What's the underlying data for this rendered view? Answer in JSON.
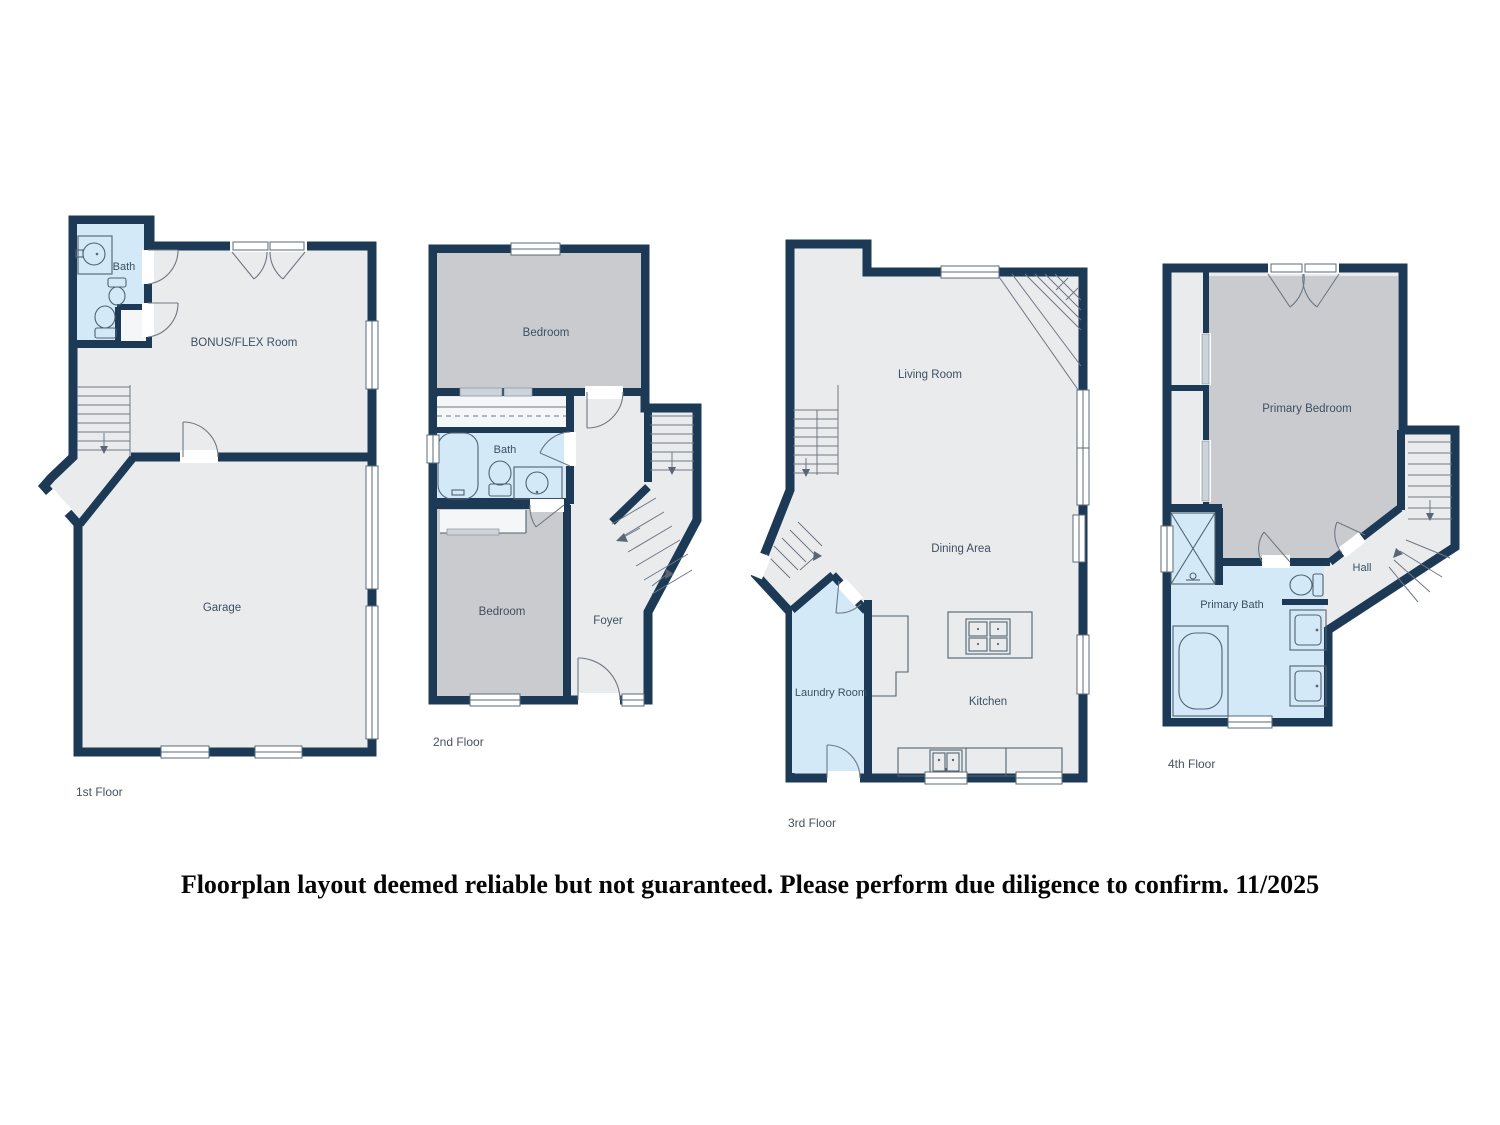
{
  "colors": {
    "wall": "#1c3a56",
    "room_fill": "#e9ebed",
    "bedroom_fill": "#c9cbce",
    "wet_room_fill": "#d3e9f8",
    "fixture_line": "#51626f",
    "label_text": "#3d4f63",
    "disclaimer_text": "#060606",
    "background": "#ffffff"
  },
  "floors": [
    {
      "label": "1st Floor",
      "rooms": [
        {
          "name": "Bath"
        },
        {
          "name": "BONUS/FLEX Room"
        },
        {
          "name": "Garage"
        }
      ]
    },
    {
      "label": "2nd Floor",
      "rooms": [
        {
          "name": "Bedroom"
        },
        {
          "name": "Bath"
        },
        {
          "name": "Bedroom"
        },
        {
          "name": "Foyer"
        }
      ]
    },
    {
      "label": "3rd Floor",
      "rooms": [
        {
          "name": "Living Room"
        },
        {
          "name": "Dining Area"
        },
        {
          "name": "Laundry Room"
        },
        {
          "name": "Kitchen"
        }
      ]
    },
    {
      "label": "4th Floor",
      "rooms": [
        {
          "name": "Primary Bedroom"
        },
        {
          "name": "Primary Bath"
        },
        {
          "name": "Hall"
        }
      ]
    }
  ],
  "disclaimer": "Floorplan layout deemed reliable but not guaranteed.  Please perform due diligence to confirm. 11/2025"
}
